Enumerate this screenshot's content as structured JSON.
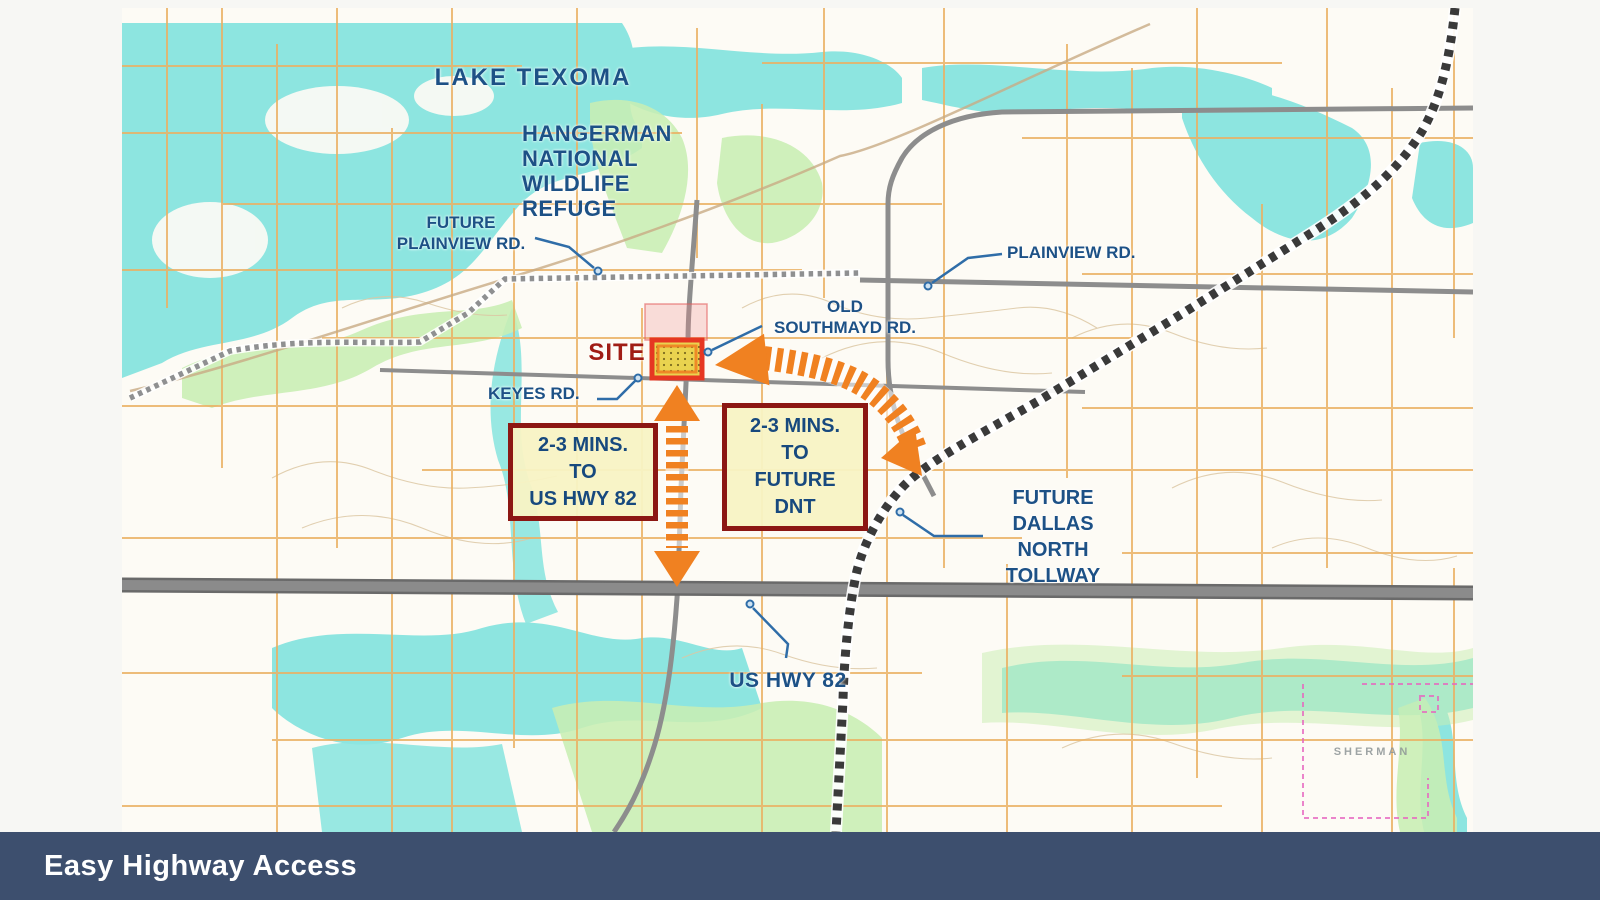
{
  "caption": {
    "title": "Easy Highway Access"
  },
  "map": {
    "labels": {
      "lake": "LAKE TEXOMA",
      "refuge": [
        "HANGERMAN",
        "NATIONAL",
        "WILDLIFE",
        "REFUGE"
      ],
      "future_plainview": [
        "FUTURE",
        "PLAINVIEW RD."
      ],
      "plainview": "PLAINVIEW RD.",
      "old_southmayd": [
        "OLD",
        "SOUTHMAYD RD."
      ],
      "keyes": "KEYES RD.",
      "site": "SITE",
      "us_hwy_82": "US HWY 82",
      "future_dnt": [
        "FUTURE",
        "DALLAS",
        "NORTH",
        "TOLLWAY"
      ],
      "sherman": "SHERMAN"
    },
    "callouts": {
      "to_us_hwy_82": [
        "2-3 MINS.",
        "TO",
        "US HWY 82"
      ],
      "to_future_dnt": [
        "2-3 MINS.",
        "TO",
        "FUTURE",
        "DNT"
      ]
    },
    "colors": {
      "label_blue": "#1d5186",
      "site_label_red": "#a01d15",
      "arrow_orange": "#f08121",
      "site_border_red": "#e63722",
      "site_fill_yellow": "#e9d34f",
      "callout_border": "#8c1713",
      "callout_fill": "#f8f3c4",
      "water_cyan": "#8de5e0",
      "vegetation_green": "#c9eeb3",
      "grid_orange": "#eab163",
      "road_gray": "#8d8d8d",
      "caption_bar": "#3d4f6e"
    }
  }
}
